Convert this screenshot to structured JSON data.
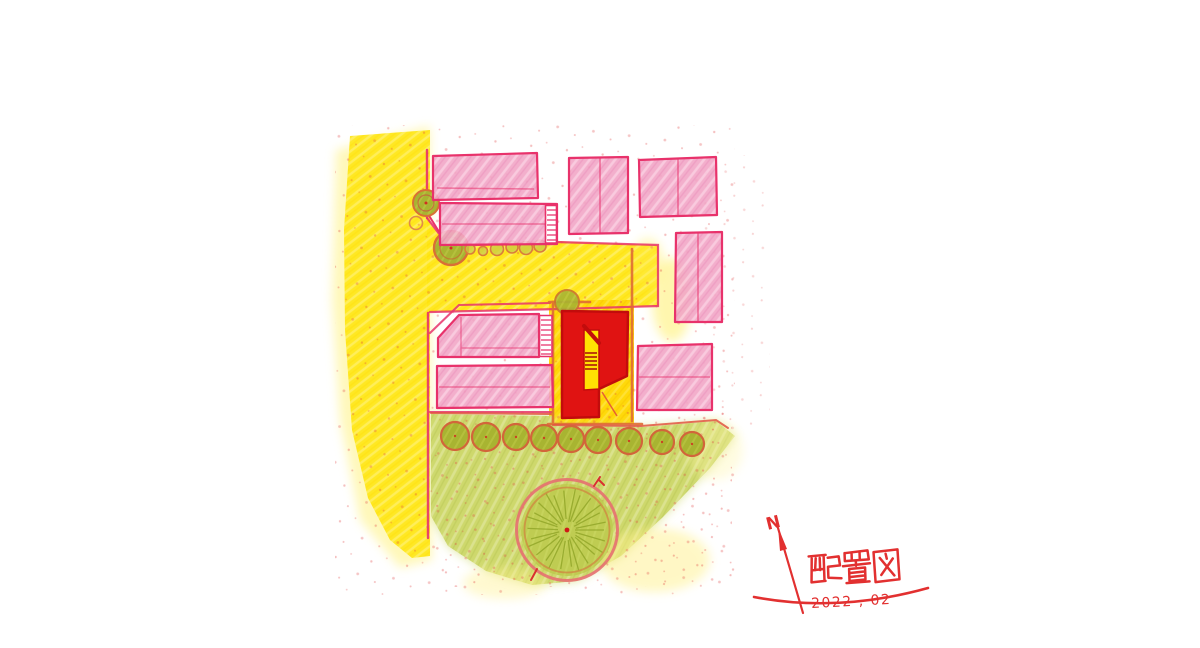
{
  "annotation": {
    "title": "配置図",
    "date_label": "2022 , 02",
    "compass_label": "N"
  },
  "colors": {
    "paper": "#FFFFFF",
    "road_yellow": "#FFE716",
    "plot_yellow": "#FFD90A",
    "building_pink": "#F2A6C6",
    "outline_crimson": "#E8326B",
    "subject_red": "#E01312",
    "subject_outline": "#C20C0C",
    "boundary_orange": "#DF6B33",
    "tree_olive": "#A8B431",
    "tree_ring_orange": "#D2803F",
    "ground_green": "#CCD768",
    "big_tree_fill": "#BFCC52",
    "ink_red": "#E23030",
    "stipple_red": "#E04040"
  },
  "counts": {
    "row_shrubs": 9,
    "street_corner_trees": 2,
    "neighbor_buildings": 8
  }
}
